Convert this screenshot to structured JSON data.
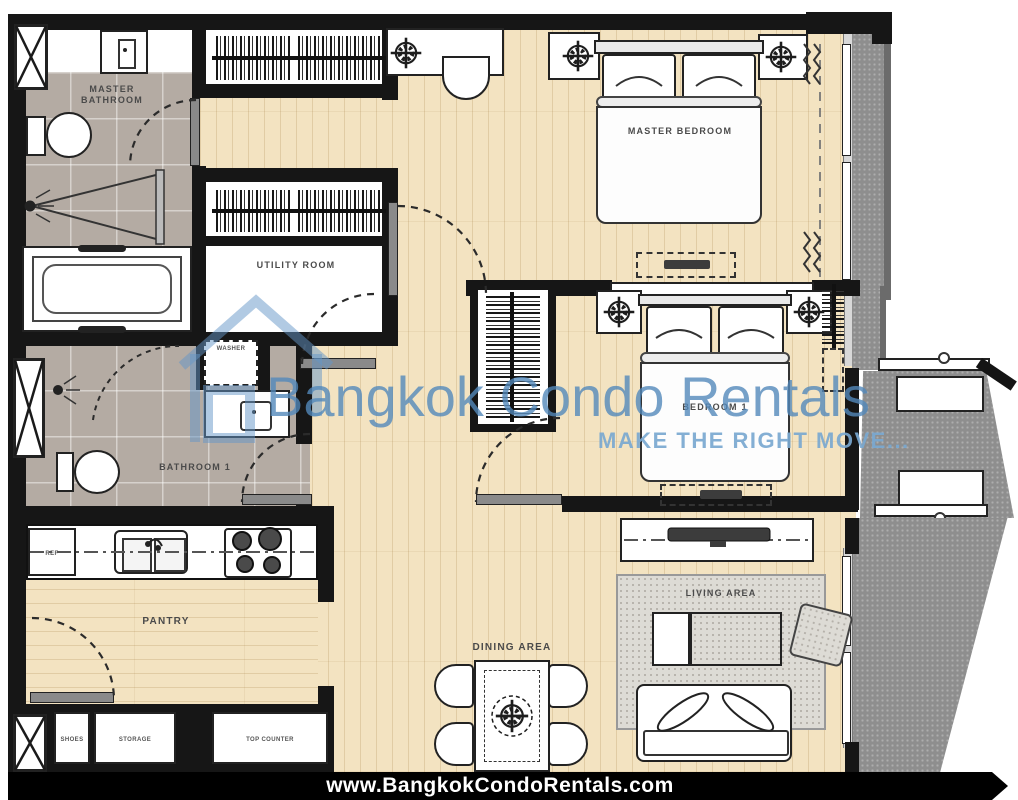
{
  "watermark": {
    "title": "Bangkok Condo Rentals",
    "tagline": "MAKE THE RIGHT MOVE..."
  },
  "footer": {
    "website": "www.BangkokCondoRentals.com"
  },
  "rooms": {
    "master_bathroom": {
      "label": "MASTER BATHROOM"
    },
    "utility_room": {
      "label": "UTILITY ROOM"
    },
    "master_bedroom": {
      "label": "MASTER BEDROOM"
    },
    "bedroom_1": {
      "label": "BEDROOM 1"
    },
    "bathroom_1": {
      "label": "BATHROOM 1"
    },
    "pantry": {
      "label": "PANTRY"
    },
    "dining_area": {
      "label": "DINING AREA"
    },
    "living_area": {
      "label": "LIVING AREA"
    }
  },
  "fixtures": {
    "washer": "WASHER",
    "refrigerator": "REF",
    "shoes": "SHOES",
    "storage": "STORAGE",
    "top_counter": "TOP COUNTER"
  },
  "colors": {
    "wood": "#f2e2c0",
    "tile": "#b3aaa2",
    "wall": "#161616",
    "balcony": "#8e8e8e",
    "watermark_blue": "#5a8fc0"
  }
}
